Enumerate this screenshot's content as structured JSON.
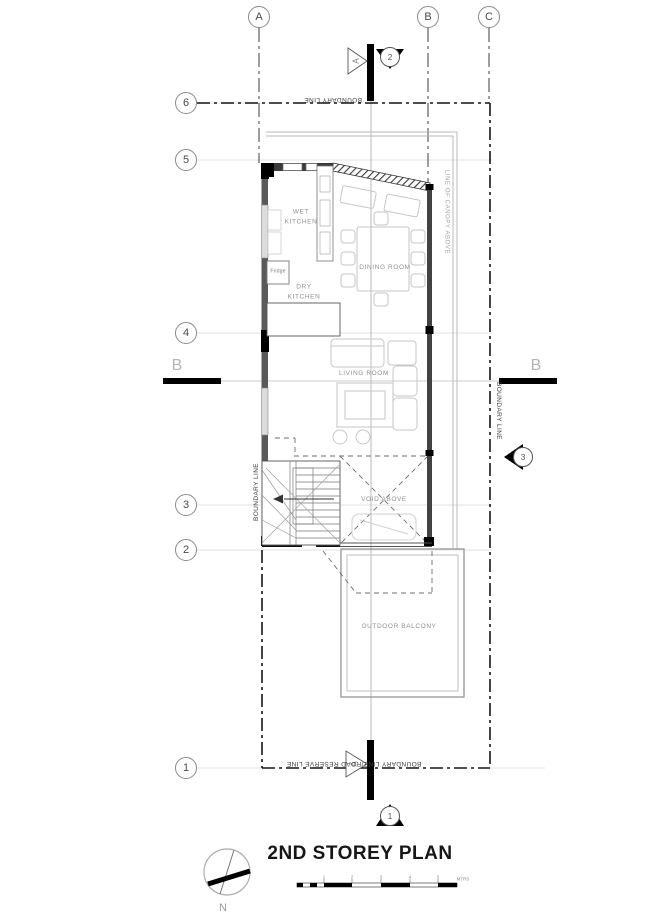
{
  "plan": {
    "title": "2ND STOREY PLAN",
    "grid": {
      "cols": [
        {
          "label": "A"
        },
        {
          "label": "B"
        },
        {
          "label": "C"
        }
      ],
      "rows": [
        {
          "label": "6"
        },
        {
          "label": "5"
        },
        {
          "label": "4"
        },
        {
          "label": "3"
        },
        {
          "label": "2"
        },
        {
          "label": "1"
        }
      ]
    },
    "sections": {
      "top": {
        "bubble": "2",
        "flag": "A"
      },
      "bottom": {
        "bubble": "1",
        "flag": "A"
      },
      "right": {
        "bubble": "3"
      },
      "b_left": "B",
      "b_right": "B"
    },
    "rooms": {
      "wet_kitchen": "WET\nKITCHEN",
      "dry_kitchen": "DRY\nKITCHEN",
      "dining": "DINING ROOM",
      "living": "LIVING ROOM",
      "void": "VOID ABOVE",
      "balcony": "OUTDOOR BALCONY",
      "fridge": "Fridge"
    },
    "boundary_labels": {
      "top": "BOUNDARY LINE",
      "left": "BOUNDARY LINE",
      "right": "BOUNDARY LINE",
      "bottom": "BOUNDARY LINE/ROAD RESERVE LINE",
      "canopy": "LINE OF CANOPY ABOVE"
    },
    "north_label": "N",
    "scale_bar": {
      "ticks": [
        "1",
        "2",
        "3",
        "4",
        "5"
      ],
      "unit": "MTRS"
    },
    "colors": {
      "ink": "#1a1a1a",
      "light_line": "#b4b4b4",
      "label_gray": "#8f8f8f"
    }
  }
}
